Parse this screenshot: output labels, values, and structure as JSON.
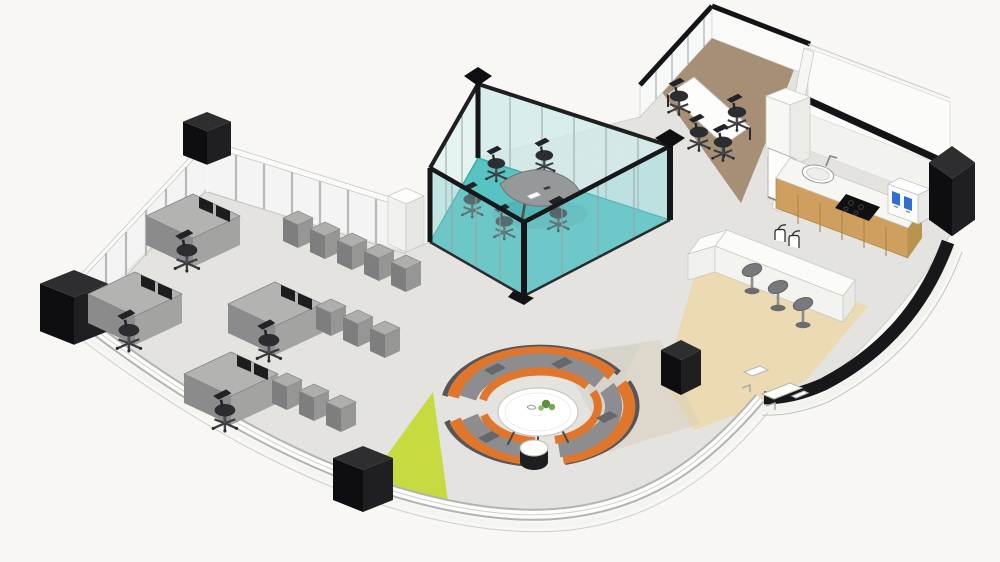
{
  "scene": {
    "title": "Isometric 3D office floor plan rendering",
    "style": "architectural cutaway illustration",
    "view": "isometric"
  },
  "canvas": {
    "width": 1000,
    "height": 562
  },
  "colors": {
    "background": "#f8f7f4",
    "floor_concrete": "#e9e8e4",
    "pod_floor_teal": "#55c4c3",
    "room_floor_brown": "#a68e73",
    "cafe_floor_tan": "#eedcb2",
    "accent_green": "#c7da3f",
    "sofa_orange": "#e0762b",
    "sofa_gray": "#8d8d8f",
    "sofa_shell_dark": "#55565a",
    "desk_gray": "#b3b3b1",
    "cube_gray": "#aeaeac",
    "wood_cabinet": "#cf9f5f",
    "counter_white": "#f6f6f2",
    "structure_black": "#18181a",
    "glass_tint": "#d8f0ef",
    "wall_white": "#fafaf8",
    "chair_black": "#2c2d30",
    "stool_gray": "#77797c",
    "table_white": "#fdfdfb",
    "plant_green": "#5d8f3f",
    "screen_blue": "#2e6fd0"
  },
  "areas": [
    {
      "id": "open_office",
      "label": "Open office desk area",
      "floor": "polished concrete",
      "desks": 4,
      "storage_cubes": 11
    },
    {
      "id": "meeting_pod",
      "label": "Glass meeting pod",
      "floor": "teal carpet",
      "seats": 5,
      "table": "gray boat-shaped conference table"
    },
    {
      "id": "private_meeting_room",
      "label": "Private meeting room",
      "floor": "brown carpet",
      "seats": 4,
      "table": "white meeting table"
    },
    {
      "id": "kitchenette",
      "label": "Kitchenette",
      "features": [
        "inset sink with faucet",
        "black cooktop",
        "oak base cabinets",
        "coffee machine with two blue screens"
      ]
    },
    {
      "id": "cafe_bar",
      "label": "Cafe bar counter",
      "floor": "light oak",
      "stools": 3,
      "counter": "white L-shaped bar"
    },
    {
      "id": "lounge",
      "label": "Circular lounge",
      "sofas": 3,
      "tables": [
        "white round coffee table with plant",
        "black drum side table"
      ]
    }
  ],
  "furniture": {
    "desks": 4,
    "desk_monitors": 8,
    "task_chairs": 13,
    "bar_stools": 3,
    "curved_sofas": 3,
    "storage_cubes": 11,
    "coffee_tables": 2,
    "conference_tables": 2
  },
  "structure": {
    "columns": 5,
    "glazing": "low perimeter glass walls with mullions",
    "curved_elements": [
      "white curved sill wall along south edge",
      "black curved wall band on east edge"
    ],
    "doors": 1
  }
}
